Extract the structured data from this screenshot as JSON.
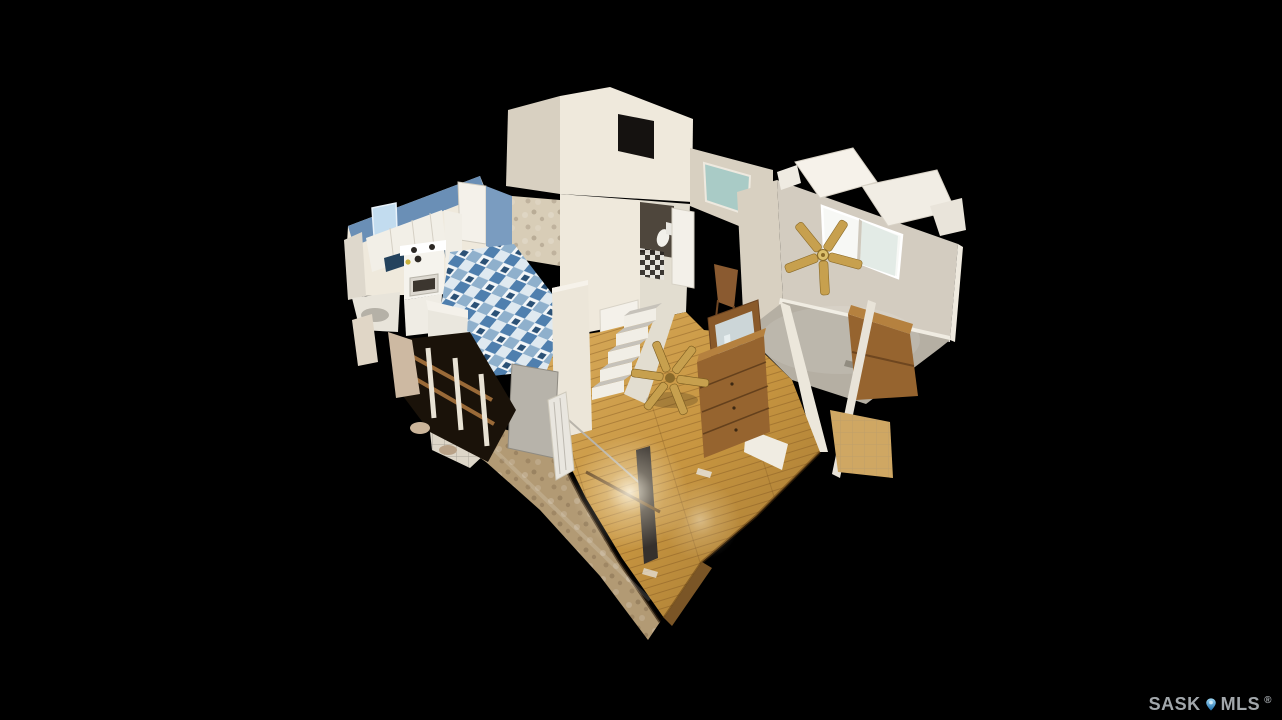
{
  "scene": {
    "description": "3D dollhouse cutaway view of a house interior (kitchen with blue checkered floor, central staircase, hardwood living-dining area, gray-carpet bedroom with ceiling fans) floating on a black background",
    "background_color": "#000000"
  },
  "watermark": {
    "prefix": "SASK",
    "suffix": "MLS",
    "registered": "®"
  },
  "palette": {
    "bg": "#000000",
    "wall_light": "#efe9dc",
    "wall_mid": "#d8d0c1",
    "bedroom_wall": "#d3ccc0",
    "carpet": "#b5afa3",
    "hardwood_light": "#e3ba6b",
    "hardwood_mid": "#c79540",
    "hardwood_dark": "#a17631",
    "tile_tan": "#b29a74",
    "kitchen_wall_blue": "#6a8fb6",
    "kitchen_floor_blue": "#4f7fae",
    "kitchen_floor_light": "#dce8f0",
    "counter_navy": "#24425d",
    "fan_brass": "#c7a04e",
    "dresser_wood": "#96642f",
    "window_teal": "#a9cbc6",
    "watermark_text": "#a2a7ab",
    "pin_blue_light": "#9fd9f7",
    "pin_blue_dark": "#1a6cab"
  }
}
